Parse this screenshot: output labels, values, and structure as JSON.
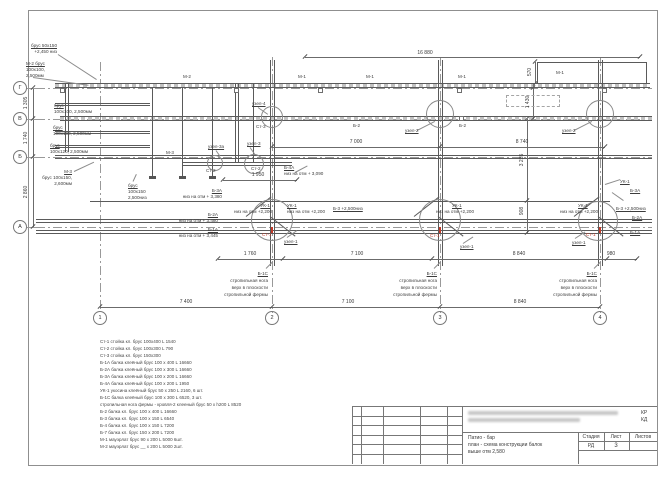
{
  "drawing": {
    "grid": {
      "rows": [
        "Г",
        "В",
        "Б",
        "А"
      ],
      "cols": [
        "1",
        "2",
        "3",
        "4"
      ]
    },
    "accent_red": "#c23b2a",
    "labels": [
      {
        "t": "брус 50x150",
        "x": 57,
        "y": 43,
        "a": "r",
        "u": 1
      },
      {
        "t": "+2,450 низ",
        "x": 57,
        "y": 49,
        "a": "r"
      },
      {
        "t": "М-2 брус",
        "x": 26,
        "y": 61,
        "u": 1
      },
      {
        "t": "100x100,",
        "x": 26,
        "y": 67
      },
      {
        "t": "2,500мм",
        "x": 26,
        "y": 73
      },
      {
        "t": "брус",
        "x": 54,
        "y": 103,
        "u": 1
      },
      {
        "t": "100x100, 2,500мм",
        "x": 54,
        "y": 109
      },
      {
        "t": "брус",
        "x": 53,
        "y": 125,
        "u": 1
      },
      {
        "t": "100x100, 2,500мм",
        "x": 53,
        "y": 131
      },
      {
        "t": "брус",
        "x": 50,
        "y": 143,
        "u": 1
      },
      {
        "t": "100x120, 2,500мм",
        "x": 50,
        "y": 149
      },
      {
        "t": "М-3",
        "x": 72,
        "y": 169,
        "a": "r",
        "u": 1
      },
      {
        "t": "брус 100x150,",
        "x": 72,
        "y": 175,
        "a": "r"
      },
      {
        "t": "2,600мм",
        "x": 72,
        "y": 181,
        "a": "r"
      },
      {
        "t": "брус",
        "x": 128,
        "y": 183,
        "u": 1
      },
      {
        "t": "100x150",
        "x": 128,
        "y": 189
      },
      {
        "t": "2,500низ",
        "x": 128,
        "y": 195
      },
      {
        "t": "Б-3А",
        "x": 222,
        "y": 188,
        "a": "r",
        "u": 1
      },
      {
        "t": "низ на отм + 3,380",
        "x": 222,
        "y": 194,
        "a": "r"
      },
      {
        "t": "Б-2А",
        "x": 218,
        "y": 212,
        "a": "r",
        "u": 1
      },
      {
        "t": "низ на отм + 3,480",
        "x": 218,
        "y": 218,
        "a": "r"
      },
      {
        "t": "Б-1А",
        "x": 218,
        "y": 227,
        "a": "r",
        "u": 1
      },
      {
        "t": "низ на отм + 3,445",
        "x": 218,
        "y": 233,
        "a": "r"
      },
      {
        "t": "Б-4А",
        "x": 284,
        "y": 165,
        "u": 1
      },
      {
        "t": "низ на отм + 3,090",
        "x": 284,
        "y": 171
      },
      {
        "t": "УК-1",
        "x": 270,
        "y": 203,
        "a": "r",
        "u": 1
      },
      {
        "t": "низ на отм +2,200",
        "x": 272,
        "y": 209,
        "a": "r"
      },
      {
        "t": "УК-1",
        "x": 287,
        "y": 203,
        "u": 1
      },
      {
        "t": "низ на отм +2,200",
        "x": 287,
        "y": 209
      },
      {
        "t": "УК-1",
        "x": 452,
        "y": 203,
        "u": 1
      },
      {
        "t": "низ на отм +2,200",
        "x": 436,
        "y": 209
      },
      {
        "t": "УК-1",
        "x": 578,
        "y": 203,
        "u": 1
      },
      {
        "t": "низ на отм +2,200",
        "x": 560,
        "y": 209
      },
      {
        "t": "УК-1",
        "x": 620,
        "y": 179,
        "u": 1
      },
      {
        "t": "Б-3 +2,500низ",
        "x": 333,
        "y": 206,
        "u": 1
      },
      {
        "t": "Б-3 +2,500низ",
        "x": 616,
        "y": 206,
        "u": 1
      },
      {
        "t": "Б-3А",
        "x": 630,
        "y": 188,
        "u": 1
      },
      {
        "t": "Б-2А",
        "x": 632,
        "y": 215,
        "u": 1
      },
      {
        "t": "Б-1А",
        "x": 630,
        "y": 230,
        "u": 1
      },
      {
        "t": "узел-4",
        "x": 252,
        "y": 101,
        "u": 1
      },
      {
        "t": "узел-3а",
        "x": 208,
        "y": 144,
        "u": 1
      },
      {
        "t": "узел-3",
        "x": 247,
        "y": 141,
        "u": 1
      },
      {
        "t": "узел-2",
        "x": 405,
        "y": 128,
        "u": 1
      },
      {
        "t": "узел-2",
        "x": 562,
        "y": 128,
        "u": 1
      },
      {
        "t": "узел-1",
        "x": 284,
        "y": 239,
        "u": 1
      },
      {
        "t": "узел-1",
        "x": 460,
        "y": 244,
        "u": 1
      },
      {
        "t": "узел-1",
        "x": 572,
        "y": 240,
        "u": 1
      },
      {
        "t": "Ст-3",
        "x": 256,
        "y": 124
      },
      {
        "t": "Ст-2",
        "x": 206,
        "y": 168
      },
      {
        "t": "Ст-2",
        "x": 251,
        "y": 166
      },
      {
        "t": "Ст-1",
        "x": 262,
        "y": 232,
        "c": "#c23b2a"
      },
      {
        "t": "Ст-1",
        "x": 430,
        "y": 233,
        "c": "#c23b2a"
      },
      {
        "t": "Ст-1",
        "x": 586,
        "y": 232,
        "c": "#c23b2a"
      },
      {
        "t": "М-2",
        "x": 183,
        "y": 74
      },
      {
        "t": "М-1",
        "x": 298,
        "y": 74
      },
      {
        "t": "М-1",
        "x": 366,
        "y": 74
      },
      {
        "t": "М-1",
        "x": 458,
        "y": 74
      },
      {
        "t": "М-1",
        "x": 556,
        "y": 70
      },
      {
        "t": "Б-2",
        "x": 353,
        "y": 123
      },
      {
        "t": "Б-2",
        "x": 459,
        "y": 123
      },
      {
        "t": "М-3",
        "x": 166,
        "y": 150
      },
      {
        "t": "Б-1С",
        "x": 268,
        "y": 271,
        "a": "r",
        "u": 1
      },
      {
        "t": "стропильная нога",
        "x": 268,
        "y": 278,
        "a": "r"
      },
      {
        "t": "верх в плоскости",
        "x": 268,
        "y": 285,
        "a": "r"
      },
      {
        "t": "стропильной фермы",
        "x": 268,
        "y": 292,
        "a": "r"
      },
      {
        "t": "Б-1С",
        "x": 437,
        "y": 271,
        "a": "r",
        "u": 1
      },
      {
        "t": "стропильная нога",
        "x": 437,
        "y": 278,
        "a": "r"
      },
      {
        "t": "верх в плоскости",
        "x": 437,
        "y": 285,
        "a": "r"
      },
      {
        "t": "стропильной фермы",
        "x": 437,
        "y": 292,
        "a": "r"
      },
      {
        "t": "Б-1С",
        "x": 597,
        "y": 271,
        "a": "r",
        "u": 1
      },
      {
        "t": "стропильная нога",
        "x": 597,
        "y": 278,
        "a": "r"
      },
      {
        "t": "верх в плоскости",
        "x": 597,
        "y": 285,
        "a": "r"
      },
      {
        "t": "стропильной фермы",
        "x": 597,
        "y": 292,
        "a": "r"
      },
      {
        "t": "16 880",
        "x": 425,
        "y": 51,
        "a": "c",
        "k": "dim"
      },
      {
        "t": "7 000",
        "x": 356,
        "y": 140,
        "a": "c",
        "k": "dim"
      },
      {
        "t": "8 740",
        "x": 522,
        "y": 140,
        "a": "c",
        "k": "dim"
      },
      {
        "t": "1 950",
        "x": 258,
        "y": 173,
        "a": "c",
        "k": "dim"
      },
      {
        "t": "1 760",
        "x": 250,
        "y": 252,
        "a": "c",
        "k": "dim"
      },
      {
        "t": "7 100",
        "x": 357,
        "y": 252,
        "a": "c",
        "k": "dim"
      },
      {
        "t": "8 840",
        "x": 519,
        "y": 252,
        "a": "c",
        "k": "dim"
      },
      {
        "t": "980",
        "x": 611,
        "y": 252,
        "a": "c",
        "k": "dim"
      },
      {
        "t": "7 400",
        "x": 186,
        "y": 300,
        "a": "c",
        "k": "dim"
      },
      {
        "t": "7 100",
        "x": 348,
        "y": 300,
        "a": "c",
        "k": "dim"
      },
      {
        "t": "8 840",
        "x": 520,
        "y": 300,
        "a": "c",
        "k": "dim"
      },
      {
        "t": "1 305",
        "x": 27,
        "y": 103,
        "rot": -90,
        "k": "dim"
      },
      {
        "t": "1 740",
        "x": 27,
        "y": 138,
        "rot": -90,
        "k": "dim"
      },
      {
        "t": "2 860",
        "x": 27,
        "y": 192,
        "rot": -90,
        "k": "dim"
      },
      {
        "t": "570",
        "x": 531,
        "y": 72,
        "rot": -90,
        "k": "dim"
      },
      {
        "t": "1 430",
        "x": 529,
        "y": 102,
        "rot": -90,
        "k": "dim"
      },
      {
        "t": "3 235",
        "x": 523,
        "y": 160,
        "rot": -90,
        "k": "dim"
      },
      {
        "t": "908",
        "x": 523,
        "y": 211,
        "rot": -90,
        "k": "dim"
      }
    ],
    "legend": {
      "lines": [
        "Ст-1  стойка кл. брус  100x400 L 1540",
        "Ст-2  стойка кл. брус  100x300 L 790",
        "Ст-3  стойка кл. брус  150x300",
        "Б-1А балка клеёный брус 100 x 400  L 16660",
        "Б-2А балка клеёный брус 100 x 300  L 16660",
        "Б-3А балка клеёный брус 100 x 200  L 16660",
        "Б-4А балка клеёный брус 100 x 200  L 1950",
        "УК-1 укосина клеёный брус 50 x 250  L 2160, 6 шт.",
        "Б-1С балка клеёный брус 100 x 300  L 6520, 3 шт.",
        "стропильная нога фермы - кровля-2 клееный брус 50 x h200 L 8520",
        "Б-2  балка кл. брус 100 x 400 L 16660",
        "Б-3  балка кл. брус 100 x 150 L 6540",
        "Б-4  балка кл. брус 100 x 150 L 7200",
        "Б-7  балка кл. брус 150 x 200 L 7200",
        "М-1 мауэрлат брус 90 x 200 L 5000  6шт.",
        "М-2 мауэрлат брус __ x 200 L 5000  2шт."
      ]
    },
    "title_block": {
      "code_top": "КР",
      "code_bottom": "КД",
      "title_lines": [
        "Патио - бар",
        "план - схема конструкции балок",
        "выше отм 2,580"
      ],
      "stage_label": "Стадия",
      "sheet_label": "Лист",
      "sheets_label": "Листов",
      "stage_value": "РД",
      "sheet_value": "3",
      "sheets_value": ""
    }
  }
}
